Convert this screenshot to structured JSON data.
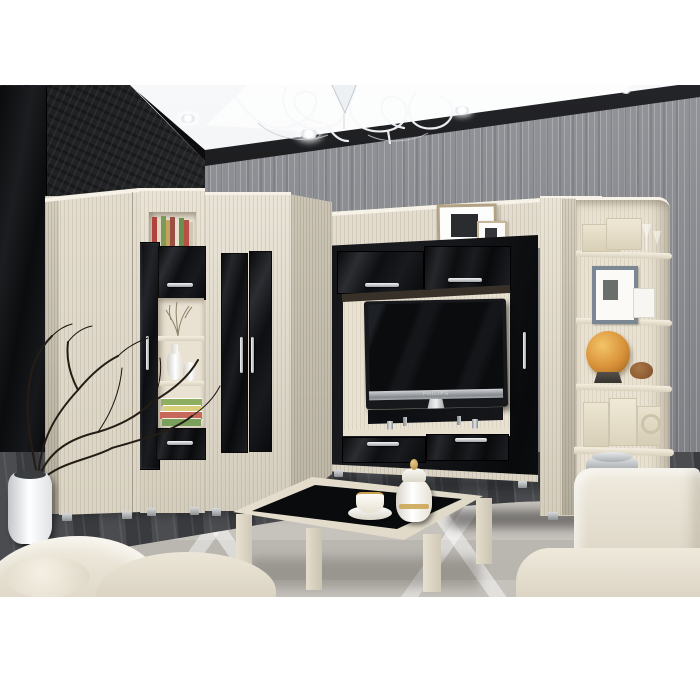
{
  "scene": {
    "type": "natural-image",
    "subject": "Living room wall-unit furniture set: light ash cabinets with glossy black fronts, TV niche, corner shelving, coffee table with black glass top, white sofas",
    "tv_brand_label": "PHILIPS"
  },
  "palette": {
    "background_white": "#ffffff",
    "ash_wood": "#e3dccb",
    "ash_shadow": "#d0c9b7",
    "black_gloss": "#111214",
    "silver": "#c6c9cc",
    "dark_wall": "#1a1b1d",
    "wallpaper_gray": "#8b8d92",
    "ceiling_white": "#f2f4f6",
    "floor_dark": "#3d3f43",
    "rug_gray": "#cbc7c1",
    "sofa_cream": "#ece6d8",
    "globe_amber": "#d89038"
  },
  "objects": [
    {
      "name": "left-wardrobe",
      "label": "Tall wardrobe"
    },
    {
      "name": "display-cabinet",
      "label": "Display cabinet with black glass door, open shelves, drawer"
    },
    {
      "name": "corner-wardrobe",
      "label": "Corner wardrobe with two glossy black doors"
    },
    {
      "name": "tv-unit",
      "label": "TV wall section with gloss black frame, two top doors, two drawers"
    },
    {
      "name": "tv",
      "label": "Flat-screen TV on black glass shelf"
    },
    {
      "name": "right-column",
      "label": "Tall side cabinet"
    },
    {
      "name": "corner-shelf",
      "label": "Open corner shelving with decor: boxes, photo frame, amber globe, tins"
    },
    {
      "name": "bridge-panel",
      "label": "Back panel with two photo frames"
    },
    {
      "name": "coffee-table",
      "label": "Coffee table, ash frame with black glass top, tea cup and urn"
    },
    {
      "name": "sofa-left",
      "label": "Cream sofa, bottom left"
    },
    {
      "name": "sofa-right",
      "label": "Cream sofa, bottom right"
    },
    {
      "name": "floor-vase",
      "label": "White floor vase with dry branches"
    },
    {
      "name": "chandelier",
      "label": "White curled-wire chandelier"
    },
    {
      "name": "spotlights",
      "label": "Recessed ceiling spotlights"
    },
    {
      "name": "rug",
      "label": "Light gray rug with diamond pattern"
    }
  ]
}
